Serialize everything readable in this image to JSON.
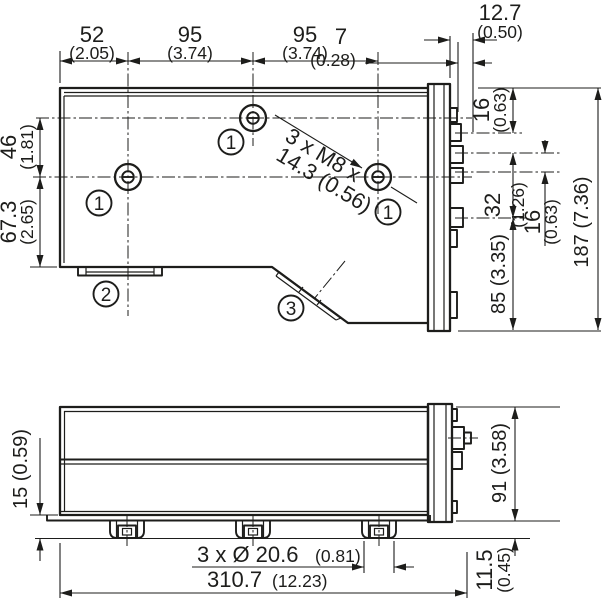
{
  "drawing": {
    "type": "technical-dimension-drawing",
    "colors": {
      "line": "#1d1d1b",
      "background": "#ffffff"
    }
  },
  "labels": {
    "top": {
      "w1_mm": "52",
      "w1_in": "(2.05)",
      "w2_mm": "95",
      "w2_in": "(3.74)",
      "w3_mm": "95",
      "w3_in": "(3.74)",
      "c7_mm": "7",
      "c7_in": "(0.28)",
      "c127_mm": "12.7",
      "c127_in": "(0.50)",
      "r16a_mm": "16",
      "r16a_in": "(0.63)",
      "r32_mm": "32",
      "r32_in": "(1.26)",
      "r16b_mm": "16",
      "r16b_in": "(0.63)",
      "r85": "85 (3.35)",
      "r187": "187 (7.36)",
      "l46_mm": "46",
      "l46_in": "(1.81)",
      "l673_mm": "67.3",
      "l673_in": "(2.65)",
      "note_line1": "3 x M8 x",
      "note_line2": "14.3 (0.56)",
      "callout1": "1",
      "callout2": "2",
      "callout3": "3"
    },
    "bottom": {
      "l15": "15 (0.59)",
      "r91": "91 (3.58)",
      "r115_mm": "11.5",
      "r115_in": "(0.45)",
      "feet_mm": "3 x Ø 20.6",
      "feet_in": "(0.81)",
      "width_mm": "310.7",
      "width_in": "(12.23)"
    }
  }
}
